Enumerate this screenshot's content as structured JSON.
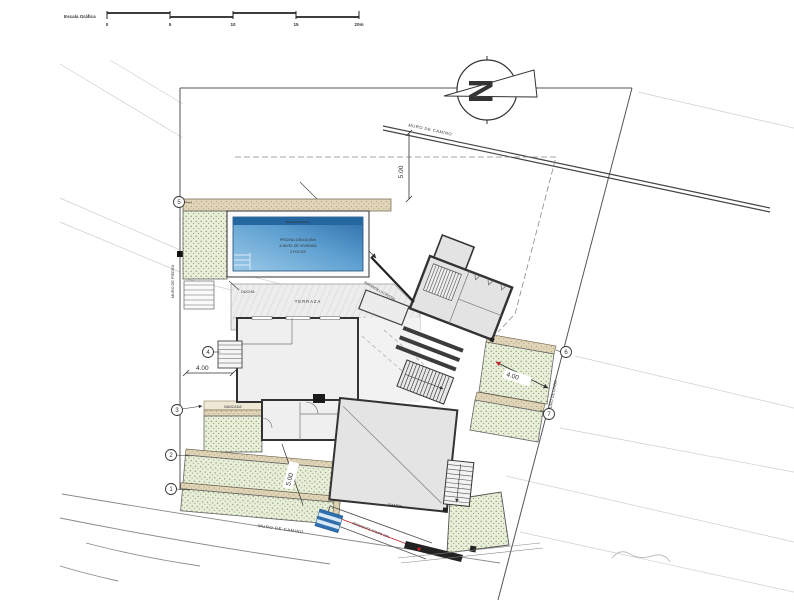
{
  "drawing": {
    "scale_bar": {
      "label": "Escala Gráfica",
      "ticks": [
        "0",
        "5",
        "10",
        "15",
        "20m"
      ]
    },
    "north": {
      "letter": "N"
    },
    "walls": {
      "road_top": "MURO DE CAMINO",
      "road_bottom": "MURO DE CAMINO",
      "linde": "MURO DE LINDE",
      "piedra": "MURO DE PIEDRA"
    },
    "labels": {
      "terraza": "TERRAZA",
      "ducha": "DUCHA",
      "bancada": "BANCADA",
      "rampa": "RAMPA",
      "barandilla": "BARANDILLA CRISTAL",
      "ramp_slope": "PENDIENTE RAMPA 18%"
    },
    "pool": {
      "line1": "PISCINA 4,50x10,50m",
      "line2": "A NIVEL DE VIVIENDA",
      "line3": "2 FOCOS",
      "bench": "BANCO 50x40cm"
    },
    "dimensions": {
      "top_setback": "5.00",
      "bottom_setback": "5.00",
      "left": "4.00",
      "right": "4.00"
    },
    "markers": {
      "m1": "1",
      "m2": "2",
      "m3": "3",
      "m4": "4",
      "m5": "5",
      "m6": "6",
      "m7": "7"
    },
    "colors": {
      "green": "#7d9c5b",
      "tan": "#cdb894",
      "pool": "#3a7fba",
      "red": "#c2262a",
      "line": "#333333"
    }
  }
}
